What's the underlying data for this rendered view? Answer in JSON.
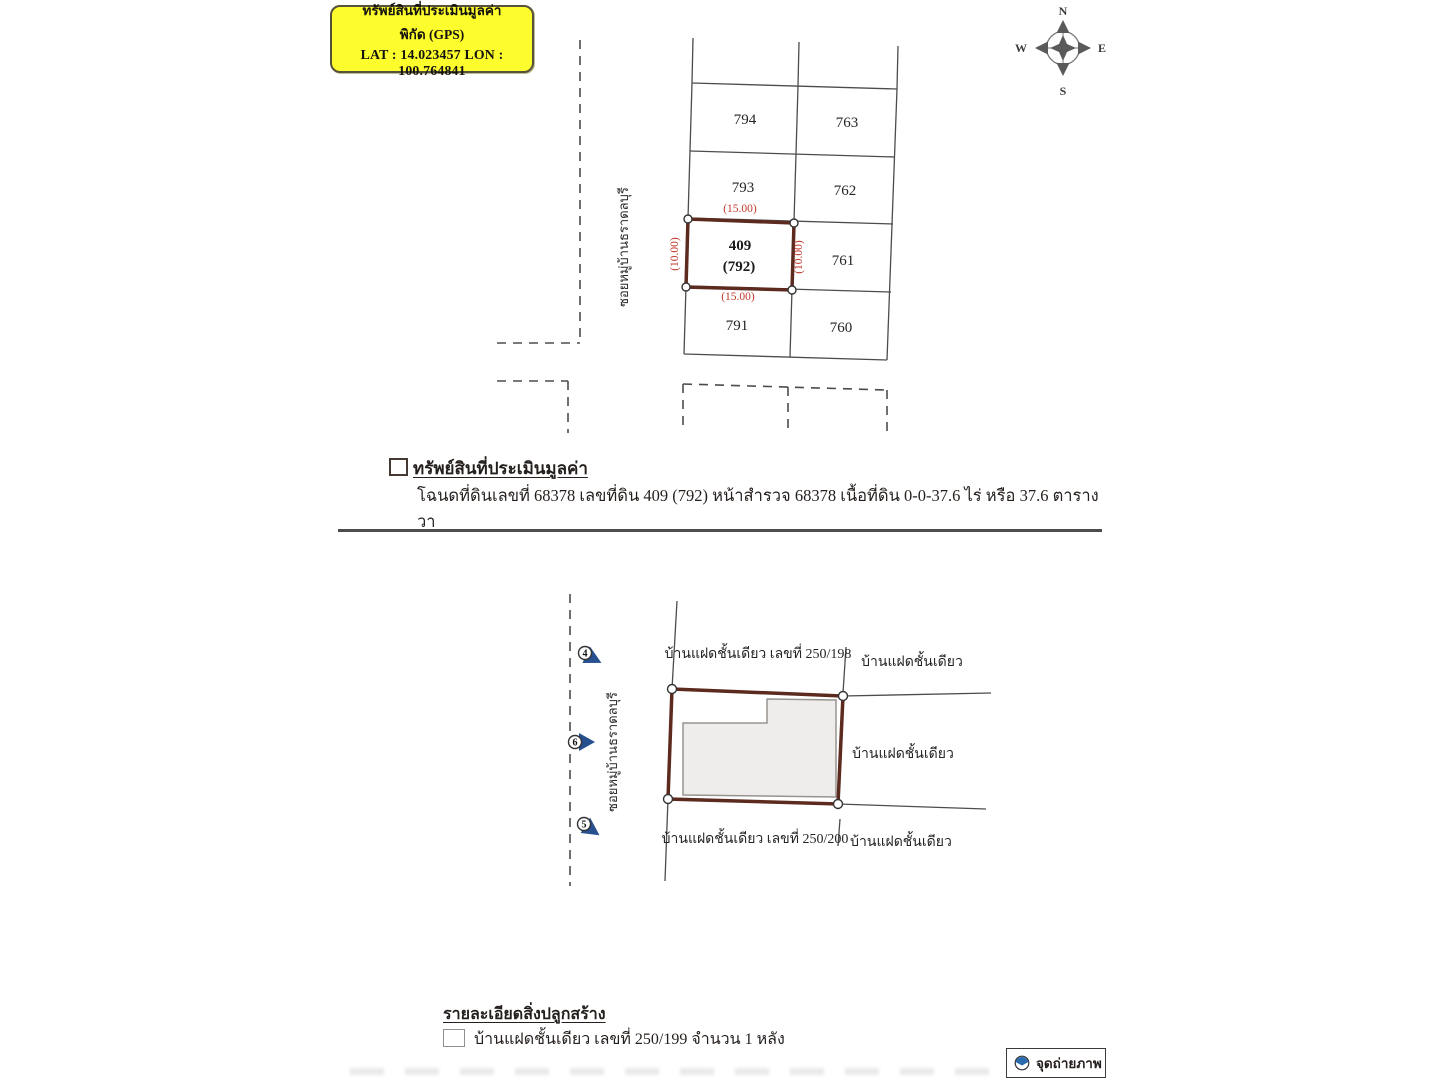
{
  "gps_box": {
    "line1": "ทรัพย์สินที่ประเมินมูลค่า",
    "line2": "พิกัด (GPS)",
    "line3": "LAT : 14.023457  LON : 100.764841"
  },
  "compass": {
    "n": "N",
    "e": "E",
    "s": "S",
    "w": "W"
  },
  "top_plan": {
    "road_label": "ซอยหมู่บ้านธราดลบุรี",
    "parcels": {
      "p794": "794",
      "p763": "763",
      "p793": "793",
      "p762": "762",
      "subject_no": "409",
      "subject_old": "(792)",
      "p761": "761",
      "p791": "791",
      "p760": "760"
    },
    "dims": {
      "top": "(15.00)",
      "bottom": "(15.00)",
      "left": "(10.00)",
      "right": "(10.00)"
    }
  },
  "section1": {
    "heading": "ทรัพย์สินที่ประเมินมูลค่า",
    "detail": "โฉนดที่ดินเลขที่ 68378 เลขที่ดิน 409 (792) หน้าสำรวจ 68378 เนื้อที่ดิน 0-0-37.6 ไร่ หรือ  37.6 ตารางวา"
  },
  "bottom_plan": {
    "road_label": "ซอยหมู่บ้านธราดลบุรี",
    "label_top": "บ้านแฝดชั้นเดียว เลขที่ 250/198",
    "label_top_right": "บ้านแฝดชั้นเดียว",
    "label_right": "บ้านแฝดชั้นเดียว",
    "label_bottom": "บ้านแฝดชั้นเดียว เลขที่ 250/200",
    "label_bottom_right": "บ้านแฝดชั้นเดียว",
    "markers": {
      "m4": "4",
      "m6": "6",
      "m5": "5"
    }
  },
  "section2": {
    "heading": "รายละเอียดสิ่งปลูกสร้าง",
    "item": "บ้านแฝดชั้นเดียว เลขที่ 250/199 จำนวน 1 หลัง"
  },
  "legend": {
    "label": "จุดถ่ายภาพ"
  },
  "colors": {
    "gps_yellow": "#fdfd2e",
    "dimension_red": "#c0392b",
    "subject_border_maroon": "#5c2a1e",
    "marker_blue": "#27508f",
    "legend_blue": "#2b6cb0"
  }
}
